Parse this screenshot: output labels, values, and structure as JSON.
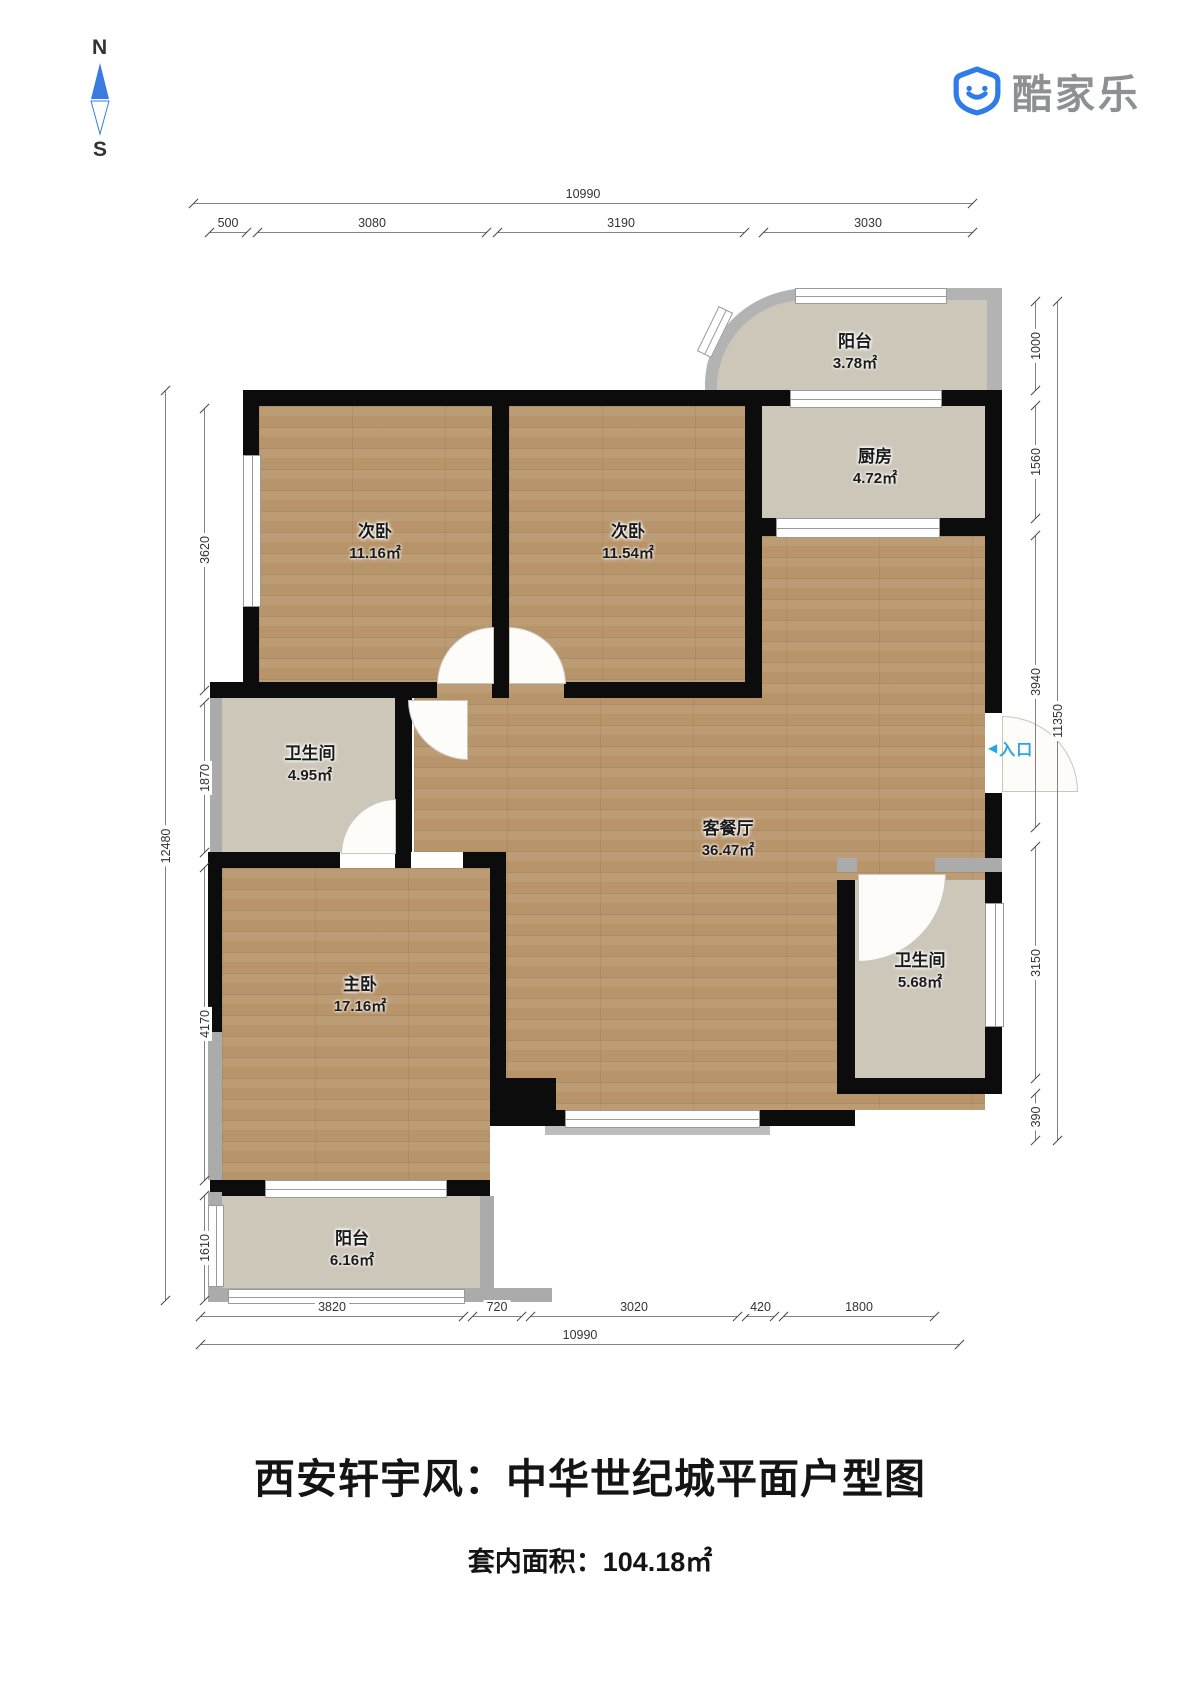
{
  "logo": {
    "brand": "酷家乐",
    "icon": "kujiale-shield-smiley"
  },
  "compass": {
    "north": "N",
    "south": "S"
  },
  "entrance": {
    "arrow": "◀",
    "label": "入口",
    "color": "#2aa7e1"
  },
  "title": "西安轩宇风：中华世纪城平面户型图",
  "subtitle": "套内面积：104.18㎡",
  "rooms": [
    {
      "id": "balcony-top",
      "name": "阳台",
      "area": "3.78㎡"
    },
    {
      "id": "kitchen",
      "name": "厨房",
      "area": "4.72㎡"
    },
    {
      "id": "bedroom-second-a",
      "name": "次卧",
      "area": "11.16㎡"
    },
    {
      "id": "bedroom-second-b",
      "name": "次卧",
      "area": "11.54㎡"
    },
    {
      "id": "bathroom-1",
      "name": "卫生间",
      "area": "4.95㎡"
    },
    {
      "id": "living-dining",
      "name": "客餐厅",
      "area": "36.47㎡"
    },
    {
      "id": "master-bedroom",
      "name": "主卧",
      "area": "17.16㎡"
    },
    {
      "id": "bathroom-2",
      "name": "卫生间",
      "area": "5.68㎡"
    },
    {
      "id": "balcony-bottom",
      "name": "阳台",
      "area": "6.16㎡"
    }
  ],
  "dimensions": {
    "top": {
      "overall": "10990",
      "segments": [
        "500",
        "3080",
        "3190",
        "3030"
      ]
    },
    "bottom": {
      "overall": "10990",
      "segments": [
        "3820",
        "720",
        "3020",
        "420",
        "1800"
      ]
    },
    "left": {
      "overall": "12480",
      "segments": [
        "3620",
        "1870",
        "4170",
        "1610"
      ]
    },
    "right": {
      "overall": "11350",
      "segments": [
        "1000",
        "1560",
        "3940",
        "3150",
        "390"
      ]
    }
  },
  "colors": {
    "wall": "#0c0c0c",
    "lightWall": "#ababab",
    "woodFloor": "#b7946a",
    "grayFloor": "#cdc7ba",
    "brandBlue": "#2f7ce8",
    "entranceBlue": "#2aa7e1"
  }
}
